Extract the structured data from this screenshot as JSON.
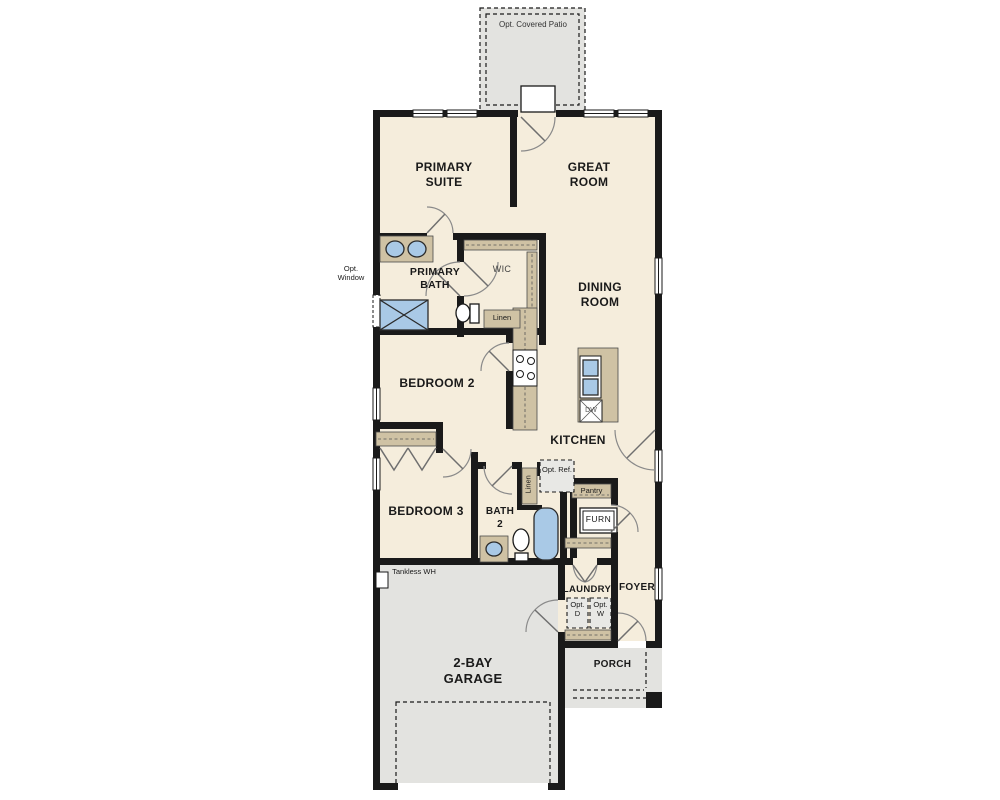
{
  "colors": {
    "floor": "#f5eddc",
    "exterior": "#e3e3e0",
    "wall": "#1a1a1a",
    "casework": "#cfc2a4",
    "fixture": "#a9c9e6",
    "text": "#1a1a1a"
  },
  "rooms": {
    "patio": {
      "label": "Opt. Covered Patio"
    },
    "primary_suite": {
      "label": "PRIMARY SUITE"
    },
    "great_room": {
      "label": "GREAT ROOM"
    },
    "primary_bath": {
      "label": "PRIMARY BATH"
    },
    "wic": {
      "label": "WIC"
    },
    "dining_room": {
      "label": "DINING ROOM"
    },
    "bedroom_2": {
      "label": "BEDROOM 2"
    },
    "kitchen": {
      "label": "KITCHEN"
    },
    "bedroom_3": {
      "label": "BEDROOM 3"
    },
    "bath_2": {
      "label": "BATH 2"
    },
    "laundry": {
      "label": "LAUNDRY"
    },
    "foyer": {
      "label": "FOYER"
    },
    "garage": {
      "label": "2-BAY GARAGE"
    },
    "porch": {
      "label": "PORCH"
    }
  },
  "fixtures": {
    "opt_window": {
      "label": "Opt. Window"
    },
    "linen_upper": {
      "label": "Linen"
    },
    "linen_lower": {
      "label": "Linen"
    },
    "opt_ref": {
      "label": "Opt. Ref."
    },
    "pantry": {
      "label": "Pantry"
    },
    "furnace": {
      "label": "FURN"
    },
    "dishwasher": {
      "label": "DW"
    },
    "opt_dryer": {
      "label": "Opt. D"
    },
    "opt_washer": {
      "label": "Opt. W"
    },
    "tankless_wh": {
      "label": "Tankless WH"
    }
  }
}
